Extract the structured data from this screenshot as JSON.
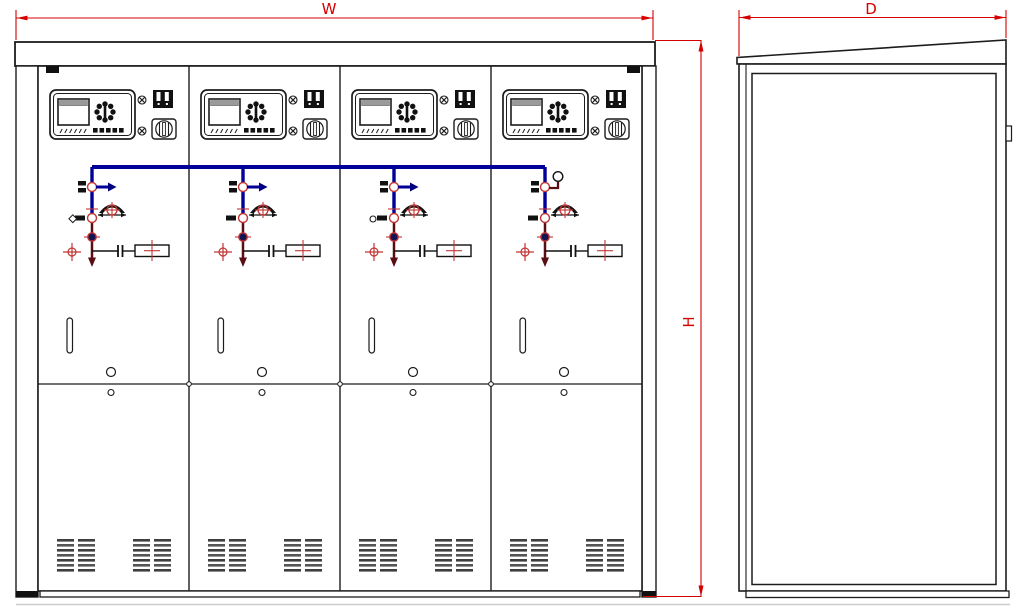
{
  "drawing_type": "switchgear-cabinet-outline-drawing",
  "dimension_labels": {
    "width": "W",
    "height": "H",
    "depth": "D"
  },
  "colors": {
    "dimension_red": "#d40000",
    "busbar_blue": "#000099",
    "arrow_navy": "#000080",
    "switch_maroon": "#5a0e14",
    "symbol_red": "#c23535",
    "line_black": "#1c1c1c"
  },
  "front_view": {
    "panel_count": 4,
    "panel_ids": [
      "panel-1",
      "panel-2",
      "panel-3",
      "panel-4"
    ],
    "grille_groups_per_panel": 2,
    "grille_columns_per_group": 2,
    "grille_bars_per_column": 7
  },
  "side_view": {
    "visible_parts": [
      "sloped-top-plate",
      "door-panel",
      "hinge",
      "base-channel"
    ]
  }
}
